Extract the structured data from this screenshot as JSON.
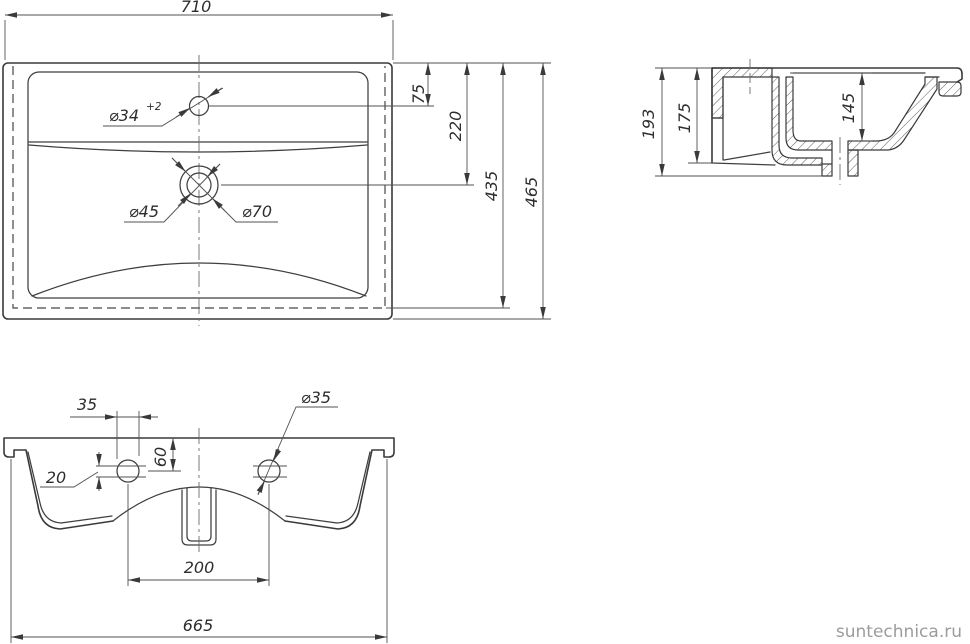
{
  "drawing": {
    "top_view": {
      "width": "710",
      "depth_overall": "465",
      "depth_inner": "435",
      "drain_offset": "220",
      "faucet_offset": "75",
      "faucet_hole": "⌀34",
      "faucet_hole_tolerance": "+2",
      "drain_inner": "⌀45",
      "drain_outer": "⌀70"
    },
    "section_view": {
      "height_total": "193",
      "height_body": "175",
      "bowl_depth": "145"
    },
    "bottom_view": {
      "width_bottom": "665",
      "hole_pitch": "200",
      "hole_top_offset": "60",
      "hole_dim_a": "35",
      "hole_dim_b": "20",
      "hole_diameter": "⌀35"
    }
  },
  "watermark": {
    "text": "suntechnica.ru"
  },
  "colors": {
    "line": "#3a3a3a",
    "dim_line": "#525252",
    "text": "#2d2d2d",
    "watermark": "#9c9c9c",
    "background": "#ffffff"
  }
}
